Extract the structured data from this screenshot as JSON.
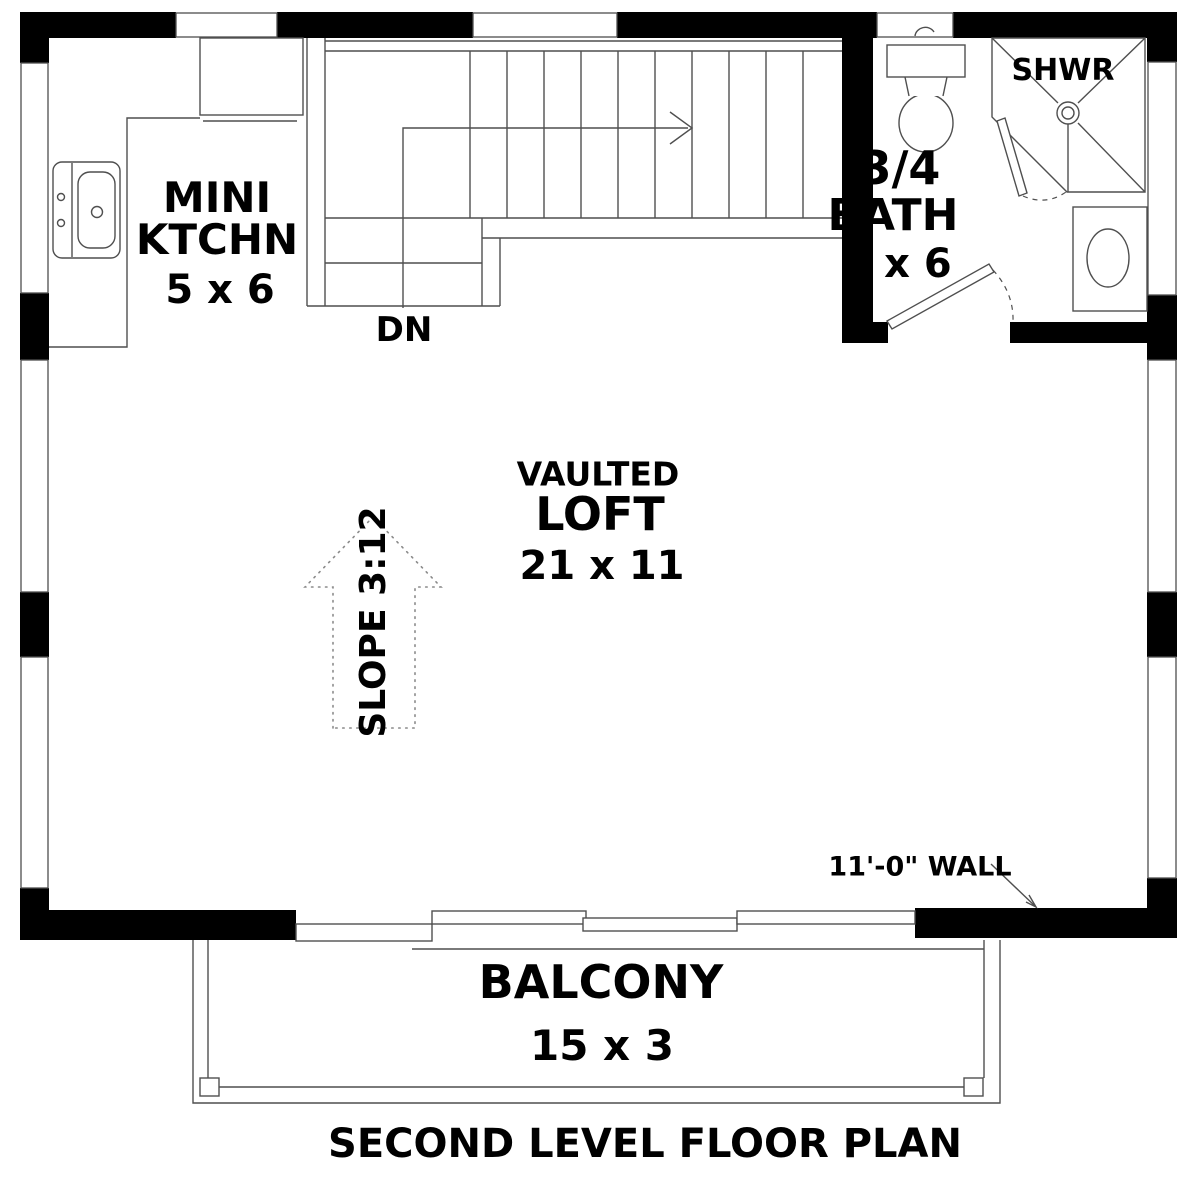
{
  "title": "SECOND LEVEL FLOOR PLAN",
  "rooms": {
    "kitchen": {
      "name_line1": "MINI",
      "name_line2": "KTCHN",
      "dimensions": "5 x 6"
    },
    "bath": {
      "name_line1": "3/4",
      "name_line2": "BATH",
      "dimensions": "6 x 6"
    },
    "shower": {
      "label": "SHWR"
    },
    "loft": {
      "name_line1": "VAULTED",
      "name_line2": "LOFT",
      "dimensions": "21 x 11"
    },
    "balcony": {
      "name": "BALCONY",
      "dimensions": "15 x 3"
    }
  },
  "annotations": {
    "stairs_direction": "DN",
    "roof_slope": "SLOPE 3:12",
    "wall_height_note": "11'-0\" WALL"
  },
  "colors": {
    "walls": "#000000",
    "thin_lines": "#4f4f4f",
    "background": "#ffffff",
    "text": "#000000"
  }
}
